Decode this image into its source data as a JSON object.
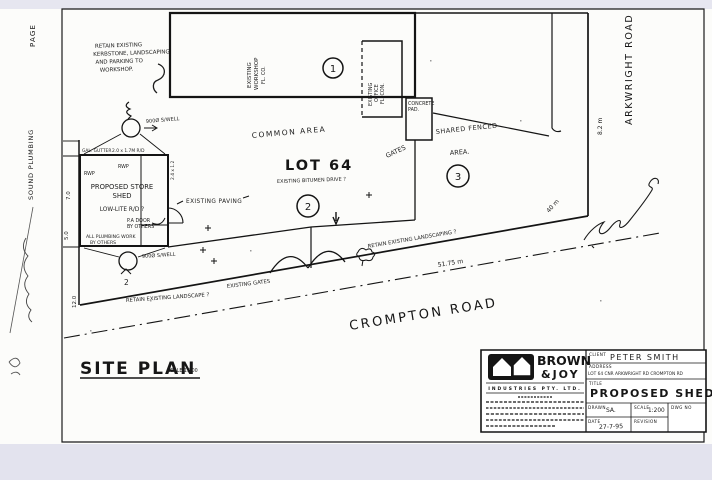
{
  "margin": {
    "page": "PAGE",
    "fax_sender": "SOUND PLUMBING"
  },
  "plan": {
    "title": "SITE PLAN",
    "title_scale": "SCALE 1:200",
    "roads": {
      "arkwright": "ARKWRIGHT ROAD",
      "crompton": "CROMPTON ROAD"
    },
    "lot": {
      "name": "LOT 64",
      "common_area": "COMMON AREA",
      "bitumen_drive": "EXISTING BITUMEN DRIVE ?"
    },
    "buildings": {
      "workshop": {
        "l1": "EXISTING",
        "l2": "WORKSHOP",
        "l3": "FL. CO.",
        "marker": "1"
      },
      "office": {
        "l1": "EXISTING",
        "l2": "OFFICE",
        "l3": "FL. CON."
      },
      "shed": {
        "l1": "PROPOSED STORE",
        "l2": "SHED",
        "l3": "LOW-LITE R/D ?",
        "marker": "2"
      },
      "pad": {
        "l1": "CONCRETE",
        "l2": "PAD."
      },
      "fenced_area": {
        "l1": "SHARED FENCED",
        "l2": "AREA.",
        "marker": "3"
      },
      "gates_label": "GATES"
    },
    "notes": {
      "kerb1": "RETAIN EXISTING",
      "kerb2": "KERBSTONE, LANDSCAPING",
      "kerb3": "AND PARKING TO",
      "kerb4": "WORKSHOP.",
      "paving": "EXISTING PAVING",
      "landscaping": "RETAIN EXISTING LANDSCAPING ?",
      "landscape": "RETAIN EXISTING LANDSCAPE ?",
      "existing_gates": "EXISTING GATES",
      "pa1": "P.A DOOR",
      "pa2": "BY OTHERS",
      "plumb1": "ALL PLUMBING WORK",
      "plumb2": "BY OTHERS",
      "rwp_a": "RWP",
      "rwp_b": "RWP",
      "gutter": "GAL. GUTTER",
      "soakwell_top": "900Ø S/WELL",
      "soakwell_bottom": "900Ø S/WELL",
      "soakwell_no": "2",
      "door_dim": "2.0 x 1.7M R/D",
      "door_dim2": "2.4 x 1.2"
    },
    "dims": {
      "south": "51.75 m",
      "east": "8.2 m",
      "splay": "40 m",
      "west_a": "7.0",
      "west_b": "5.0",
      "west_c": "12.0"
    }
  },
  "titleblock": {
    "brand_top": "BROWN",
    "brand_bottom": "&JOY",
    "industries": "INDUSTRIES PTY. LTD.",
    "client_label": "CLIENT",
    "client": "PETER SMITH",
    "address_label": "ADDRESS",
    "address": "LOT 64 CNR ARKWRIGHT RD CROMPTON RD",
    "title_label": "TITLE",
    "title": "PROPOSED SHED",
    "drawn_label": "DRAWN",
    "drawn": "SA.",
    "scale_label": "SCALE",
    "scale": "1:200",
    "dwg_label": "DWG NO",
    "date_label": "DATE",
    "date": "27-7-95",
    "revision_label": "REVISION"
  }
}
